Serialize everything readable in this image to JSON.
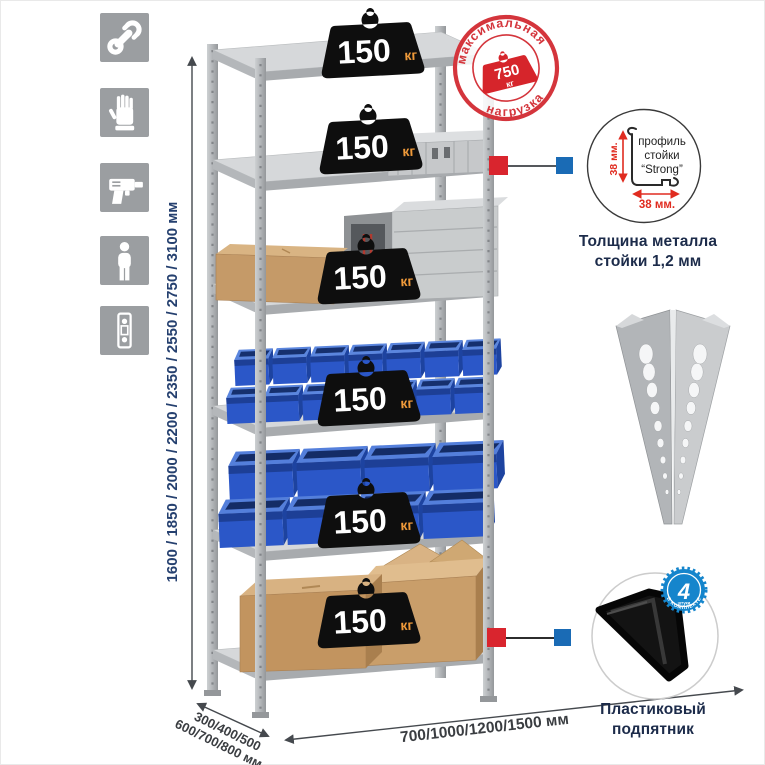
{
  "features": {
    "icons": [
      "wrench-icon",
      "gloves-icon",
      "drill-icon",
      "person-icon",
      "rack-profile-icon"
    ]
  },
  "dimensions": {
    "height": "1600 / 1850 / 2000 / 2200 / 2350 / 2550 / 2750 / 3100 мм",
    "depth_top": "300/400/500",
    "depth_bottom": "600/700/800 мм",
    "width": "700/1000/1200/1500 мм"
  },
  "stamp": {
    "arc_top": "максимальная",
    "arc_bottom": "нагрузка",
    "value": "750",
    "unit": "кг"
  },
  "shelf_load": {
    "value": "150",
    "unit": "кг",
    "shelf_count": "6"
  },
  "profile_callout": {
    "line1": "профиль",
    "line2": "стойки",
    "line3": "“Strong”",
    "vertical_dim": "38 мм.",
    "horizontal_dim": "38 мм.",
    "caption1": "Толщина металла",
    "caption2": "стойки 1,2 мм"
  },
  "foot_callout": {
    "badge_number": "4",
    "badge_sub": "штуки",
    "badge_arc": "в комплекте",
    "caption1": "Пластиковый",
    "caption2": "подпятник"
  },
  "colors": {
    "accent_red": "#d4353c",
    "accent_blue": "#1a6bb5",
    "bin_blue": "#2b57c8",
    "navy": "#1c2b4a",
    "dim_blue": "#25406f"
  }
}
